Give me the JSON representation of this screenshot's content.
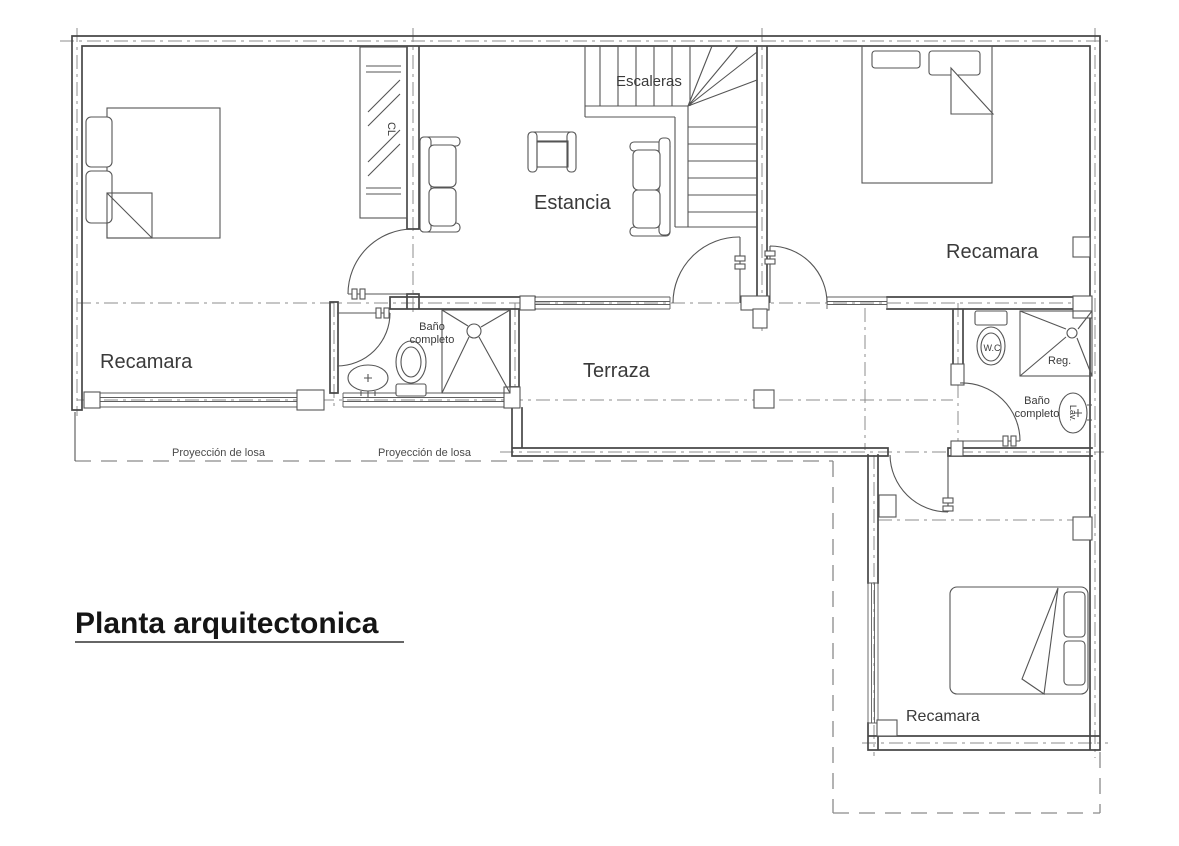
{
  "title": {
    "text": "Planta arquitectonica"
  },
  "rooms": {
    "bedroom_left": "Recamara",
    "living": "Estancia",
    "terrace": "Terraza",
    "stairs": "Escaleras",
    "bedroom_right": "Recamara",
    "bedroom_bottom": "Recamara",
    "bath_middle": {
      "line1": "Baño",
      "line2": "completo"
    },
    "bath_right": {
      "line1": "Baño",
      "line2": "completo"
    }
  },
  "fixtures": {
    "toilet": "W.C",
    "shower": "Reg.",
    "sink": "Lav.",
    "closet": "CL"
  },
  "annotations": {
    "slab_1": "Proyección de losa",
    "slab_2": "Proyección de losa"
  },
  "colors": {
    "wall_line": "#474747",
    "thin_line": "#555555",
    "axis_line": "#8c8c8c",
    "text": "#3a3a3a",
    "background": "#ffffff"
  }
}
